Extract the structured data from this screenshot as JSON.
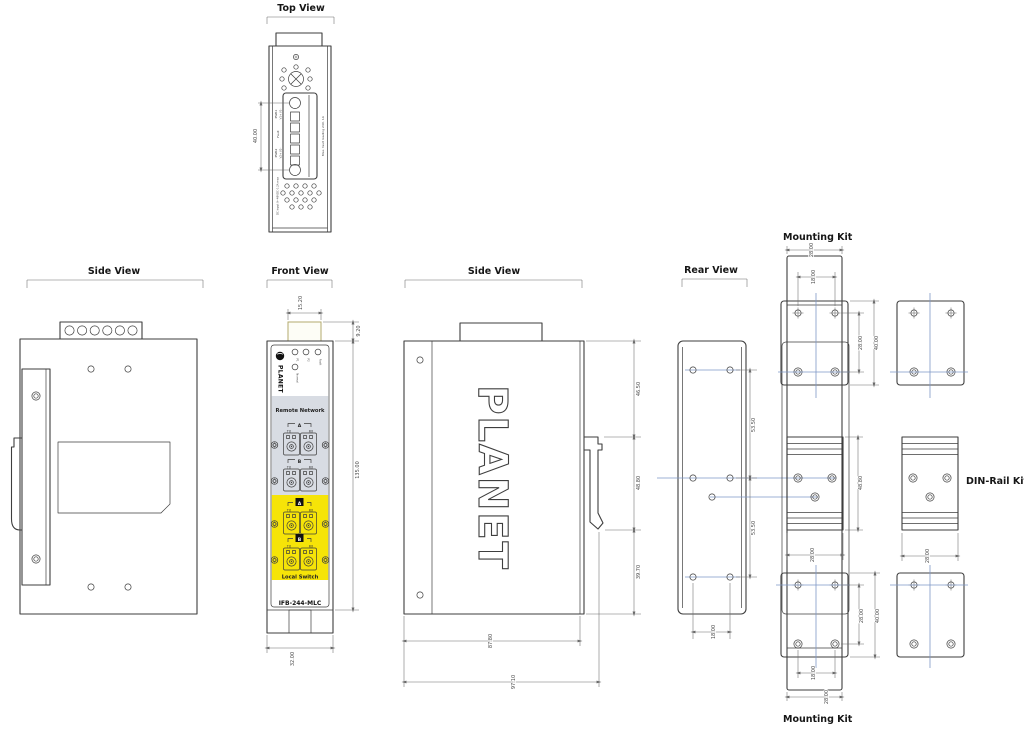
{
  "colors": {
    "line": "#3e3e3e",
    "dimension": "#6a6a6a",
    "construction_blue": "#7e97c6",
    "remote_gray": "#d8dce3",
    "local_yellow": "#f6e408",
    "protrusion_olive": "#b3aa6d"
  },
  "top_view": {
    "title": "Top View",
    "dim_height": "40.00",
    "terminal": {
      "pwr1": "PWR1",
      "v1": "V1+ V1-",
      "fault": "Fault",
      "pwr2": "PWR2",
      "v2": "V2+ V2-",
      "dc_input": "DC input 9~48VDC 0.2A max",
      "max_loading": "Max. fault loading 24V, 1A"
    }
  },
  "side_view_left": {
    "title": "Side View"
  },
  "front_view": {
    "title": "Front View",
    "dims": {
      "top_width": "15.20",
      "top_height": "9.20",
      "body_height": "135.00",
      "body_width": "32.00"
    },
    "panel": {
      "brand": "PLANET",
      "leds": {
        "p1": "P1",
        "p2": "P2",
        "fault": "Fault",
        "normal": "Normal"
      },
      "remote_section": "Remote Network",
      "local_section": "Local Switch",
      "port_a": "A",
      "port_b": "B",
      "tx": "TX",
      "rx": "RX",
      "model": "IFB-244-MLC"
    }
  },
  "side_view_mid": {
    "title": "Side View",
    "brand": "PLANET",
    "dims": {
      "upper": "46.50",
      "middle": "48.80",
      "lower": "39.70",
      "depth_body": "87.80",
      "depth_total": "97.10"
    }
  },
  "rear_view": {
    "title": "Rear View",
    "dims": {
      "upper_span": "53.50",
      "lower_span": "53.50",
      "hole_span": "18.00"
    }
  },
  "mounting_kit_top": {
    "title": "Mounting Kit",
    "dims": {
      "plate_width": "28.00",
      "hole_span": "18.00",
      "hole_pitch": "28.00",
      "plate_height": "40.00"
    }
  },
  "din_rail_kit": {
    "label": "DIN-Rail Kit",
    "dims": {
      "height": "48.80",
      "width_assembled": "28.00",
      "width_part": "28.00"
    }
  },
  "mounting_kit_bottom": {
    "title": "Mounting Kit",
    "dims": {
      "hole_pitch": "28.00",
      "plate_height": "40.00",
      "hole_span": "18.00",
      "plate_width": "28.00"
    }
  }
}
